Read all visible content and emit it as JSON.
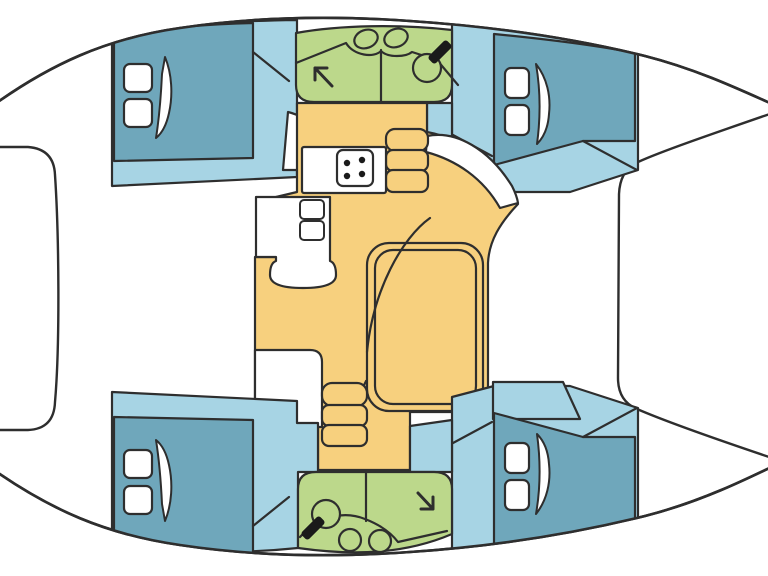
{
  "palette": {
    "outline": "#2e2e2e",
    "white": "#ffffff",
    "teal": "#6fa7bb",
    "blue": "#a7d4e4",
    "green": "#bcd88b",
    "yellow": "#f7d07e",
    "dark": "#1a1a1a"
  },
  "hull_path": "M -20,115 C 50,62 110,38 180,28 C 260,16 340,16 410,21 C 500,27 580,40 645,56 C 700,70 745,92 790,112 L 790,458 C 745,480 700,502 645,516 C 580,532 500,546 410,552 C 340,557 260,557 180,545 C 110,535 50,512 -20,460 Z",
  "shapes": [
    {
      "name": "hull-deck",
      "kind": "path",
      "d": "@hull",
      "fill": "white",
      "sw": 2.6,
      "layer": "base"
    },
    {
      "name": "foredeck-locker",
      "kind": "path",
      "d": "M -30,147 L 28,147 Q 54,149 55,175 C 59,235 60,345 55,402 Q 54,429 28,430 L -30,430 Z",
      "fill": "white",
      "sw": 2.4,
      "layer": "clipped"
    },
    {
      "name": "cockpit",
      "kind": "path",
      "d": "M 790,107 C 700,138 660,152 638,162 Q 620,170 619,194 L 618,378 Q 618,401 637,409 C 660,419 700,434 790,464 Z",
      "fill": "white",
      "sw": 2.4,
      "layer": "clipped"
    },
    {
      "name": "cabin-fwd-port-floor",
      "kind": "path",
      "d": "M 112,36 C 160,26 220,21 297,20 L 297,177 L 112,186 Z",
      "fill": "blue",
      "sw": 2.2,
      "layer": "clipped"
    },
    {
      "name": "cabin-fwd-port-berth",
      "kind": "path",
      "d": "M 114,36 C 160,28 210,24 253,23 L 253,158 L 114,161 Z",
      "fill": "teal",
      "sw": 2.2,
      "layer": "clipped"
    },
    {
      "name": "cabin-fwd-port-wall-line",
      "kind": "path",
      "d": "M 253,52 L 289,81",
      "fill": "none",
      "sw": 2.2,
      "layer": "clipped"
    },
    {
      "name": "cabin-fwd-port-door",
      "kind": "path",
      "d": "M 288,112 L 283,170 L 332,170 C 329,140 313,118 288,112 Z",
      "fill": "white",
      "sw": 2.2,
      "layer": "clipped"
    },
    {
      "name": "cabin-fwd-port-hatch-1",
      "kind": "rect",
      "x": 124,
      "y": 64,
      "w": 28,
      "h": 28,
      "rx": 6,
      "fill": "white",
      "sw": 2.2,
      "layer": "clipped"
    },
    {
      "name": "cabin-fwd-port-hatch-2",
      "kind": "rect",
      "x": 124,
      "y": 99,
      "w": 28,
      "h": 28,
      "rx": 6,
      "fill": "white",
      "sw": 2.2,
      "layer": "clipped"
    },
    {
      "name": "cabin-fwd-port-hatch-lid",
      "kind": "path",
      "d": "M 165,57 C 172,74 173,95 169,113 C 166,127 161,134 156,138 C 159,119 161,95 162,74 Z",
      "fill": "white",
      "sw": 2,
      "layer": "clipped"
    },
    {
      "name": "cabin-fwd-stbd-floor",
      "kind": "path",
      "d": "M 452,23 C 510,27 580,40 638,54 L 638,170 L 570,192 L 494,192 L 452,181 Z",
      "fill": "blue",
      "sw": 2.2,
      "layer": "clipped"
    },
    {
      "name": "corridor-top",
      "kind": "path",
      "d": "M 427,103 L 452,103 L 452,180 L 445,180 C 440,158 435,146 427,140 Z",
      "fill": "blue",
      "sw": 2.2,
      "layer": "clipped"
    },
    {
      "name": "cabin-fwd-stbd-berth",
      "kind": "path",
      "d": "M 494,34 C 545,39 600,46 635,53 L 635,141 L 583,141 L 494,165 Z",
      "fill": "teal",
      "sw": 2.2,
      "layer": "clipped"
    },
    {
      "name": "cabin-fwd-stbd-wall-line",
      "kind": "path",
      "d": "M 453,135 L 492,156",
      "fill": "none",
      "sw": 2.2,
      "layer": "clipped"
    },
    {
      "name": "cabin-fwd-stbd-corner-line",
      "kind": "path",
      "d": "M 583,141 L 637,170",
      "fill": "none",
      "sw": 2.2,
      "layer": "clipped"
    },
    {
      "name": "cabin-fwd-stbd-hatch-1",
      "kind": "rect",
      "x": 505,
      "y": 68,
      "w": 24,
      "h": 30,
      "rx": 6,
      "fill": "white",
      "sw": 2.2,
      "layer": "clipped"
    },
    {
      "name": "cabin-fwd-stbd-hatch-2",
      "kind": "rect",
      "x": 505,
      "y": 105,
      "w": 24,
      "h": 30,
      "rx": 6,
      "fill": "white",
      "sw": 2.2,
      "layer": "clipped"
    },
    {
      "name": "cabin-fwd-stbd-hatch-lid",
      "kind": "path",
      "d": "M 536,64 C 547,78 551,96 549,114 C 548,129 543,138 537,144 C 540,122 541,93 536,64 Z",
      "fill": "white",
      "sw": 2,
      "layer": "clipped"
    },
    {
      "name": "bathroom-fwd",
      "kind": "path",
      "d": "M 296,33 C 340,25 400,24 452,30 L 452,85 Q 452,102 434,102 L 314,102 Q 296,102 296,85 Z",
      "fill": "green",
      "sw": 2.2,
      "layer": "clipped"
    },
    {
      "name": "bathroom-fwd-divider",
      "kind": "path",
      "d": "M 381,50 L 381,101",
      "fill": "none",
      "sw": 2.2,
      "layer": "clipped"
    },
    {
      "name": "bathroom-fwd-counter",
      "kind": "path",
      "d": "M 296,63 L 346,43 C 354,56 374,58 381,51 C 388,58 406,57 412,52 L 437,60 L 458,85",
      "fill": "none",
      "sw": 2.2,
      "layer": "clipped"
    },
    {
      "name": "bathroom-fwd-sink-1",
      "kind": "ellipse",
      "rx": 12,
      "ry": 9,
      "transform": "translate(366,39) rotate(-20)",
      "fill": "green",
      "sw": 2.2,
      "layer": "clipped"
    },
    {
      "name": "bathroom-fwd-sink-2",
      "kind": "ellipse",
      "rx": 12,
      "ry": 9,
      "transform": "translate(396,38) rotate(-20)",
      "fill": "green",
      "sw": 2.2,
      "layer": "clipped"
    },
    {
      "name": "bathroom-fwd-toilet",
      "kind": "circle",
      "cx": 427,
      "cy": 68,
      "r": 14,
      "fill": "green",
      "sw": 2.2,
      "layer": "clipped"
    },
    {
      "name": "bathroom-fwd-toilet-seat",
      "kind": "rect",
      "x": -5,
      "y": -13,
      "w": 10,
      "h": 26,
      "rx": 3,
      "transform": "translate(440,52) rotate(45)",
      "fill": "dark",
      "stroke": false,
      "layer": "clipped"
    },
    {
      "name": "bathroom-fwd-shower-arrow",
      "kind": "path",
      "d": "M 332,86 L 315,68 M 315,68 L 315,80 M 315,68 L 327,68",
      "fill": "none",
      "sw": 3,
      "layer": "clipped"
    },
    {
      "name": "salon-floor",
      "kind": "path",
      "d": "M 297,103 L 427,103 L 427,132 C 465,139 498,167 518,204 C 500,223 489,241 488,263 L 488,390 Q 488,412 464,412 L 410,412 L 410,470 L 318,470 L 318,424 L 255,424 L 255,257 L 276,257 L 276,197 L 297,192 Z",
      "fill": "yellow",
      "sw": 2.2,
      "layer": "clipped"
    },
    {
      "name": "entry-walkway",
      "kind": "path",
      "d": "M 427,136 C 456,130 489,149 512,186 Q 517,196 518,203 L 500,208 C 483,178 456,160 426,152 Z",
      "fill": "white",
      "sw": 2.2,
      "layer": "clipped"
    },
    {
      "name": "galley-steps-1",
      "kind": "rect",
      "x": 386,
      "y": 129,
      "w": 42,
      "h": 22,
      "rx": 9,
      "fill": "yellow",
      "sw": 2.2,
      "layer": "clipped"
    },
    {
      "name": "galley-steps-2",
      "kind": "rect",
      "x": 386,
      "y": 150,
      "w": 42,
      "h": 21,
      "rx": 7,
      "fill": "yellow",
      "sw": 2.2,
      "layer": "clipped"
    },
    {
      "name": "galley-steps-3",
      "kind": "rect",
      "x": 386,
      "y": 170,
      "w": 42,
      "h": 22,
      "rx": 7,
      "fill": "yellow",
      "sw": 2.2,
      "layer": "clipped"
    },
    {
      "name": "galley-counter",
      "kind": "rect",
      "x": 302,
      "y": 147,
      "w": 84,
      "h": 46,
      "rx": 2,
      "fill": "white",
      "sw": 2.2,
      "layer": "clipped"
    },
    {
      "name": "stove",
      "kind": "rect",
      "x": 337,
      "y": 150,
      "w": 36,
      "h": 36,
      "rx": 6,
      "fill": "white",
      "sw": 2.2,
      "layer": "clipped"
    },
    {
      "name": "stove-burner-1",
      "kind": "circle",
      "cx": 347,
      "cy": 163,
      "r": 3.2,
      "fill": "dark",
      "stroke": false,
      "layer": "clipped"
    },
    {
      "name": "stove-burner-2",
      "kind": "circle",
      "cx": 362,
      "cy": 160,
      "r": 3.2,
      "fill": "dark",
      "stroke": false,
      "layer": "clipped"
    },
    {
      "name": "stove-burner-3",
      "kind": "circle",
      "cx": 362,
      "cy": 174,
      "r": 3.2,
      "fill": "dark",
      "stroke": false,
      "layer": "clipped"
    },
    {
      "name": "stove-burner-4",
      "kind": "circle",
      "cx": 347,
      "cy": 176,
      "r": 3.2,
      "fill": "dark",
      "stroke": false,
      "layer": "clipped"
    },
    {
      "name": "galley-column",
      "kind": "path",
      "d": "M 256,197 L 330,197 L 330,261 Q 336,263 336,275 Q 336,288 303,288 Q 270,288 270,275 Q 270,263 276,261 L 276,257 L 256,257 Z",
      "fill": "white",
      "sw": 2.2,
      "layer": "clipped"
    },
    {
      "name": "galley-drawer-1",
      "kind": "rect",
      "x": 300,
      "y": 200,
      "w": 24,
      "h": 19,
      "rx": 4,
      "fill": "white",
      "sw": 2,
      "layer": "clipped"
    },
    {
      "name": "galley-drawer-2",
      "kind": "rect",
      "x": 300,
      "y": 221,
      "w": 24,
      "h": 19,
      "rx": 4,
      "fill": "white",
      "sw": 2,
      "layer": "clipped"
    },
    {
      "name": "sofa-outer-edge",
      "kind": "rect",
      "x": 367,
      "y": 243,
      "w": 116,
      "h": 168,
      "rx": 22,
      "fill": "none",
      "sw": 2.2,
      "layer": "clipped"
    },
    {
      "name": "salon-table",
      "kind": "rect",
      "x": 375,
      "y": 250,
      "w": 101,
      "h": 154,
      "rx": 18,
      "fill": "none",
      "sw": 2.2,
      "layer": "clipped"
    },
    {
      "name": "sofa-back-curve",
      "kind": "path",
      "d": "M 430,218 C 402,238 373,290 367,352",
      "fill": "none",
      "sw": 2.2,
      "layer": "clipped"
    },
    {
      "name": "sofa-step-curve",
      "kind": "path",
      "d": "M 330,413 C 346,409 360,396 366,381",
      "fill": "none",
      "sw": 2.2,
      "layer": "clipped"
    },
    {
      "name": "nav-cabinet",
      "kind": "path",
      "d": "M 255,350 L 310,350 Q 322,350 322,362 L 322,427 L 255,427 Z",
      "fill": "white",
      "sw": 2.2,
      "layer": "clipped"
    },
    {
      "name": "hull-steps-1",
      "kind": "rect",
      "x": 322,
      "y": 383,
      "w": 45,
      "h": 23,
      "rx": 10,
      "fill": "yellow",
      "sw": 2.2,
      "layer": "clipped"
    },
    {
      "name": "hull-steps-2",
      "kind": "rect",
      "x": 322,
      "y": 405,
      "w": 45,
      "h": 21,
      "rx": 7,
      "fill": "yellow",
      "sw": 2.2,
      "layer": "clipped"
    },
    {
      "name": "hull-steps-3",
      "kind": "rect",
      "x": 322,
      "y": 425,
      "w": 45,
      "h": 21,
      "rx": 7,
      "fill": "yellow",
      "sw": 2.2,
      "layer": "clipped"
    },
    {
      "name": "seat-box",
      "kind": "rect",
      "x": 292,
      "y": 424,
      "w": 26,
      "h": 27,
      "rx": 4,
      "fill": "blue",
      "sw": 2,
      "layer": "clipped"
    },
    {
      "name": "cabin-aft-port-floor",
      "kind": "path",
      "d": "M 112,392 L 297,401 L 297,423 L 318,423 L 318,472 L 298,472 L 298,548 C 230,555 160,552 112,542 Z",
      "fill": "blue",
      "sw": 2.2,
      "layer": "clipped"
    },
    {
      "name": "cabin-aft-port-berth",
      "kind": "path",
      "d": "M 114,417 L 253,420 L 253,555 C 205,554 158,549 114,542 Z",
      "fill": "teal",
      "sw": 2.2,
      "layer": "clipped"
    },
    {
      "name": "cabin-aft-port-wall-line",
      "kind": "path",
      "d": "M 253,526 L 289,497",
      "fill": "none",
      "sw": 2.2,
      "layer": "clipped"
    },
    {
      "name": "cabin-aft-port-hatch-1",
      "kind": "rect",
      "x": 124,
      "y": 450,
      "w": 28,
      "h": 28,
      "rx": 6,
      "fill": "white",
      "sw": 2.2,
      "layer": "clipped"
    },
    {
      "name": "cabin-aft-port-hatch-2",
      "kind": "rect",
      "x": 124,
      "y": 486,
      "w": 28,
      "h": 28,
      "rx": 6,
      "fill": "white",
      "sw": 2.2,
      "layer": "clipped"
    },
    {
      "name": "cabin-aft-port-hatch-lid",
      "kind": "path",
      "d": "M 165,521 C 172,504 173,483 169,465 C 166,451 161,444 156,440 C 159,459 161,483 162,504 Z",
      "fill": "white",
      "sw": 2,
      "layer": "clipped"
    },
    {
      "name": "cabin-aft-stbd-floor",
      "kind": "path",
      "d": "M 452,555 C 510,551 580,538 638,524 L 638,408 L 570,386 L 494,386 L 452,397 Z",
      "fill": "blue",
      "sw": 2.2,
      "layer": "clipped"
    },
    {
      "name": "corridor-bottom",
      "kind": "path",
      "d": "M 410,426 L 452,420 L 452,472 L 410,472 Z",
      "fill": "blue",
      "sw": 2.2,
      "layer": "clipped"
    },
    {
      "name": "aft-platform",
      "kind": "path",
      "d": "M 493,382 L 563,382 L 580,419 L 493,419 Z",
      "fill": "blue",
      "sw": 2.2,
      "layer": "clipped"
    },
    {
      "name": "cabin-aft-stbd-berth",
      "kind": "path",
      "d": "M 494,544 C 545,539 600,532 635,525 L 635,437 L 583,437 L 494,413 Z",
      "fill": "teal",
      "sw": 2.2,
      "layer": "clipped"
    },
    {
      "name": "cabin-aft-stbd-wall-line",
      "kind": "path",
      "d": "M 453,443 L 492,422",
      "fill": "none",
      "sw": 2.2,
      "layer": "clipped"
    },
    {
      "name": "cabin-aft-stbd-corner-line",
      "kind": "path",
      "d": "M 583,437 L 637,408",
      "fill": "none",
      "sw": 2.2,
      "layer": "clipped"
    },
    {
      "name": "cabin-aft-stbd-hatch-1",
      "kind": "rect",
      "x": 505,
      "y": 443,
      "w": 24,
      "h": 30,
      "rx": 6,
      "fill": "white",
      "sw": 2.2,
      "layer": "clipped"
    },
    {
      "name": "cabin-aft-stbd-hatch-2",
      "kind": "rect",
      "x": 505,
      "y": 480,
      "w": 24,
      "h": 30,
      "rx": 6,
      "fill": "white",
      "sw": 2.2,
      "layer": "clipped"
    },
    {
      "name": "cabin-aft-stbd-hatch-lid",
      "kind": "path",
      "d": "M 536,514 C 547,500 551,482 549,464 C 548,449 543,440 537,434 C 540,456 541,485 536,514 Z",
      "fill": "white",
      "sw": 2,
      "layer": "clipped"
    },
    {
      "name": "bathroom-aft",
      "kind": "path",
      "d": "M 316,472 Q 298,472 298,489 L 298,548 C 355,556 405,554 452,534 L 452,489 Q 452,472 434,472 Z",
      "fill": "green",
      "sw": 2.2,
      "layer": "clipped"
    },
    {
      "name": "bathroom-aft-divider",
      "kind": "path",
      "d": "M 366,473 L 366,521",
      "fill": "none",
      "sw": 2.2,
      "layer": "clipped"
    },
    {
      "name": "bathroom-aft-counter",
      "kind": "path",
      "d": "M 300,537 C 320,515 345,511 365,519 C 383,526 392,534 398,542 L 447,531",
      "fill": "none",
      "sw": 2.2,
      "layer": "clipped"
    },
    {
      "name": "bathroom-aft-sink-1",
      "kind": "circle",
      "cx": 350,
      "cy": 540,
      "r": 11,
      "fill": "green",
      "sw": 2.2,
      "layer": "clipped"
    },
    {
      "name": "bathroom-aft-sink-2",
      "kind": "circle",
      "cx": 380,
      "cy": 541,
      "r": 11,
      "fill": "green",
      "sw": 2.2,
      "layer": "clipped"
    },
    {
      "name": "bathroom-aft-toilet",
      "kind": "circle",
      "cx": 326,
      "cy": 514,
      "r": 14,
      "fill": "green",
      "sw": 2.2,
      "layer": "clipped"
    },
    {
      "name": "bathroom-aft-toilet-seat",
      "kind": "rect",
      "x": -5,
      "y": -13,
      "w": 10,
      "h": 26,
      "rx": 3,
      "transform": "translate(313,528) rotate(45)",
      "fill": "dark",
      "stroke": false,
      "layer": "clipped"
    },
    {
      "name": "bathroom-aft-shower-arrow",
      "kind": "path",
      "d": "M 418,493 L 433,509 M 433,509 L 433,497 M 433,509 L 421,509",
      "fill": "none",
      "sw": 3,
      "layer": "clipped"
    },
    {
      "name": "hull-outline",
      "kind": "path",
      "d": "@hull",
      "fill": "none",
      "sw": 2.6,
      "layer": "top"
    }
  ]
}
